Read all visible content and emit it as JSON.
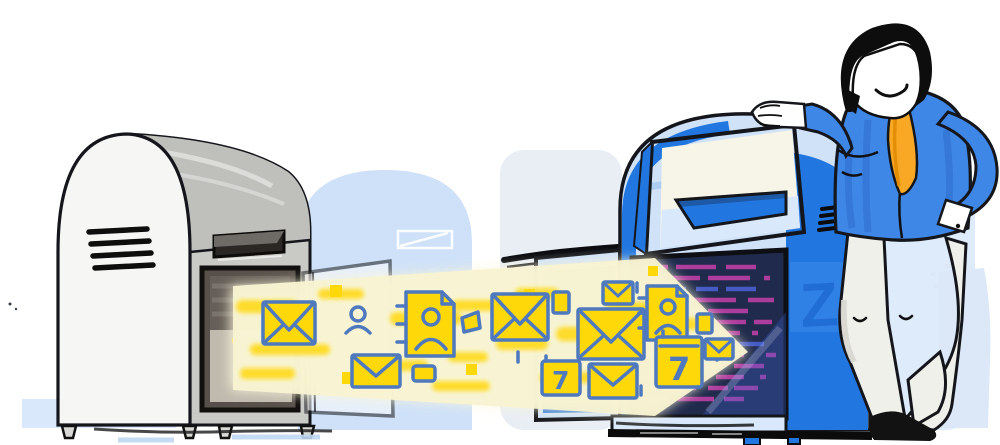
{
  "labels": {
    "calendar_large_day": "7",
    "calendar_small_day": "7",
    "watermark_letter": "Z"
  },
  "colors": {
    "yellow": "#FFD80A",
    "icon_stroke": "#4E79BE",
    "glow": "#F8F3D2",
    "blue_strong": "#2176E0",
    "blue_light": "#CFE2F8",
    "blue_ghost": "#D9E8FA",
    "blue_ghost_soft": "#E9EEF5",
    "interior_navy": "#202A4C",
    "magenta": "#BD3FA6",
    "gray_front": "#F6F6F4",
    "gray_side": "#C9C9C6",
    "gray_top": "#BFBFBC",
    "door_interior": "#57504A",
    "door_panel": "#CFC9BD",
    "shirt_blue": "#3F87E6",
    "shirt_shade": "#2E6CCB",
    "tie_orange": "#F9A825",
    "tie_shade": "#E08900",
    "pants": "#F0F0EB",
    "hair": "#0D0D0D",
    "outline": "#14161B",
    "background": "#FFFFFF"
  },
  "icons": [
    "envelope-icon",
    "contact-person-icon",
    "address-book-icon",
    "calendar-icon",
    "tag-icon",
    "data-pixel",
    "migration-arrow"
  ]
}
